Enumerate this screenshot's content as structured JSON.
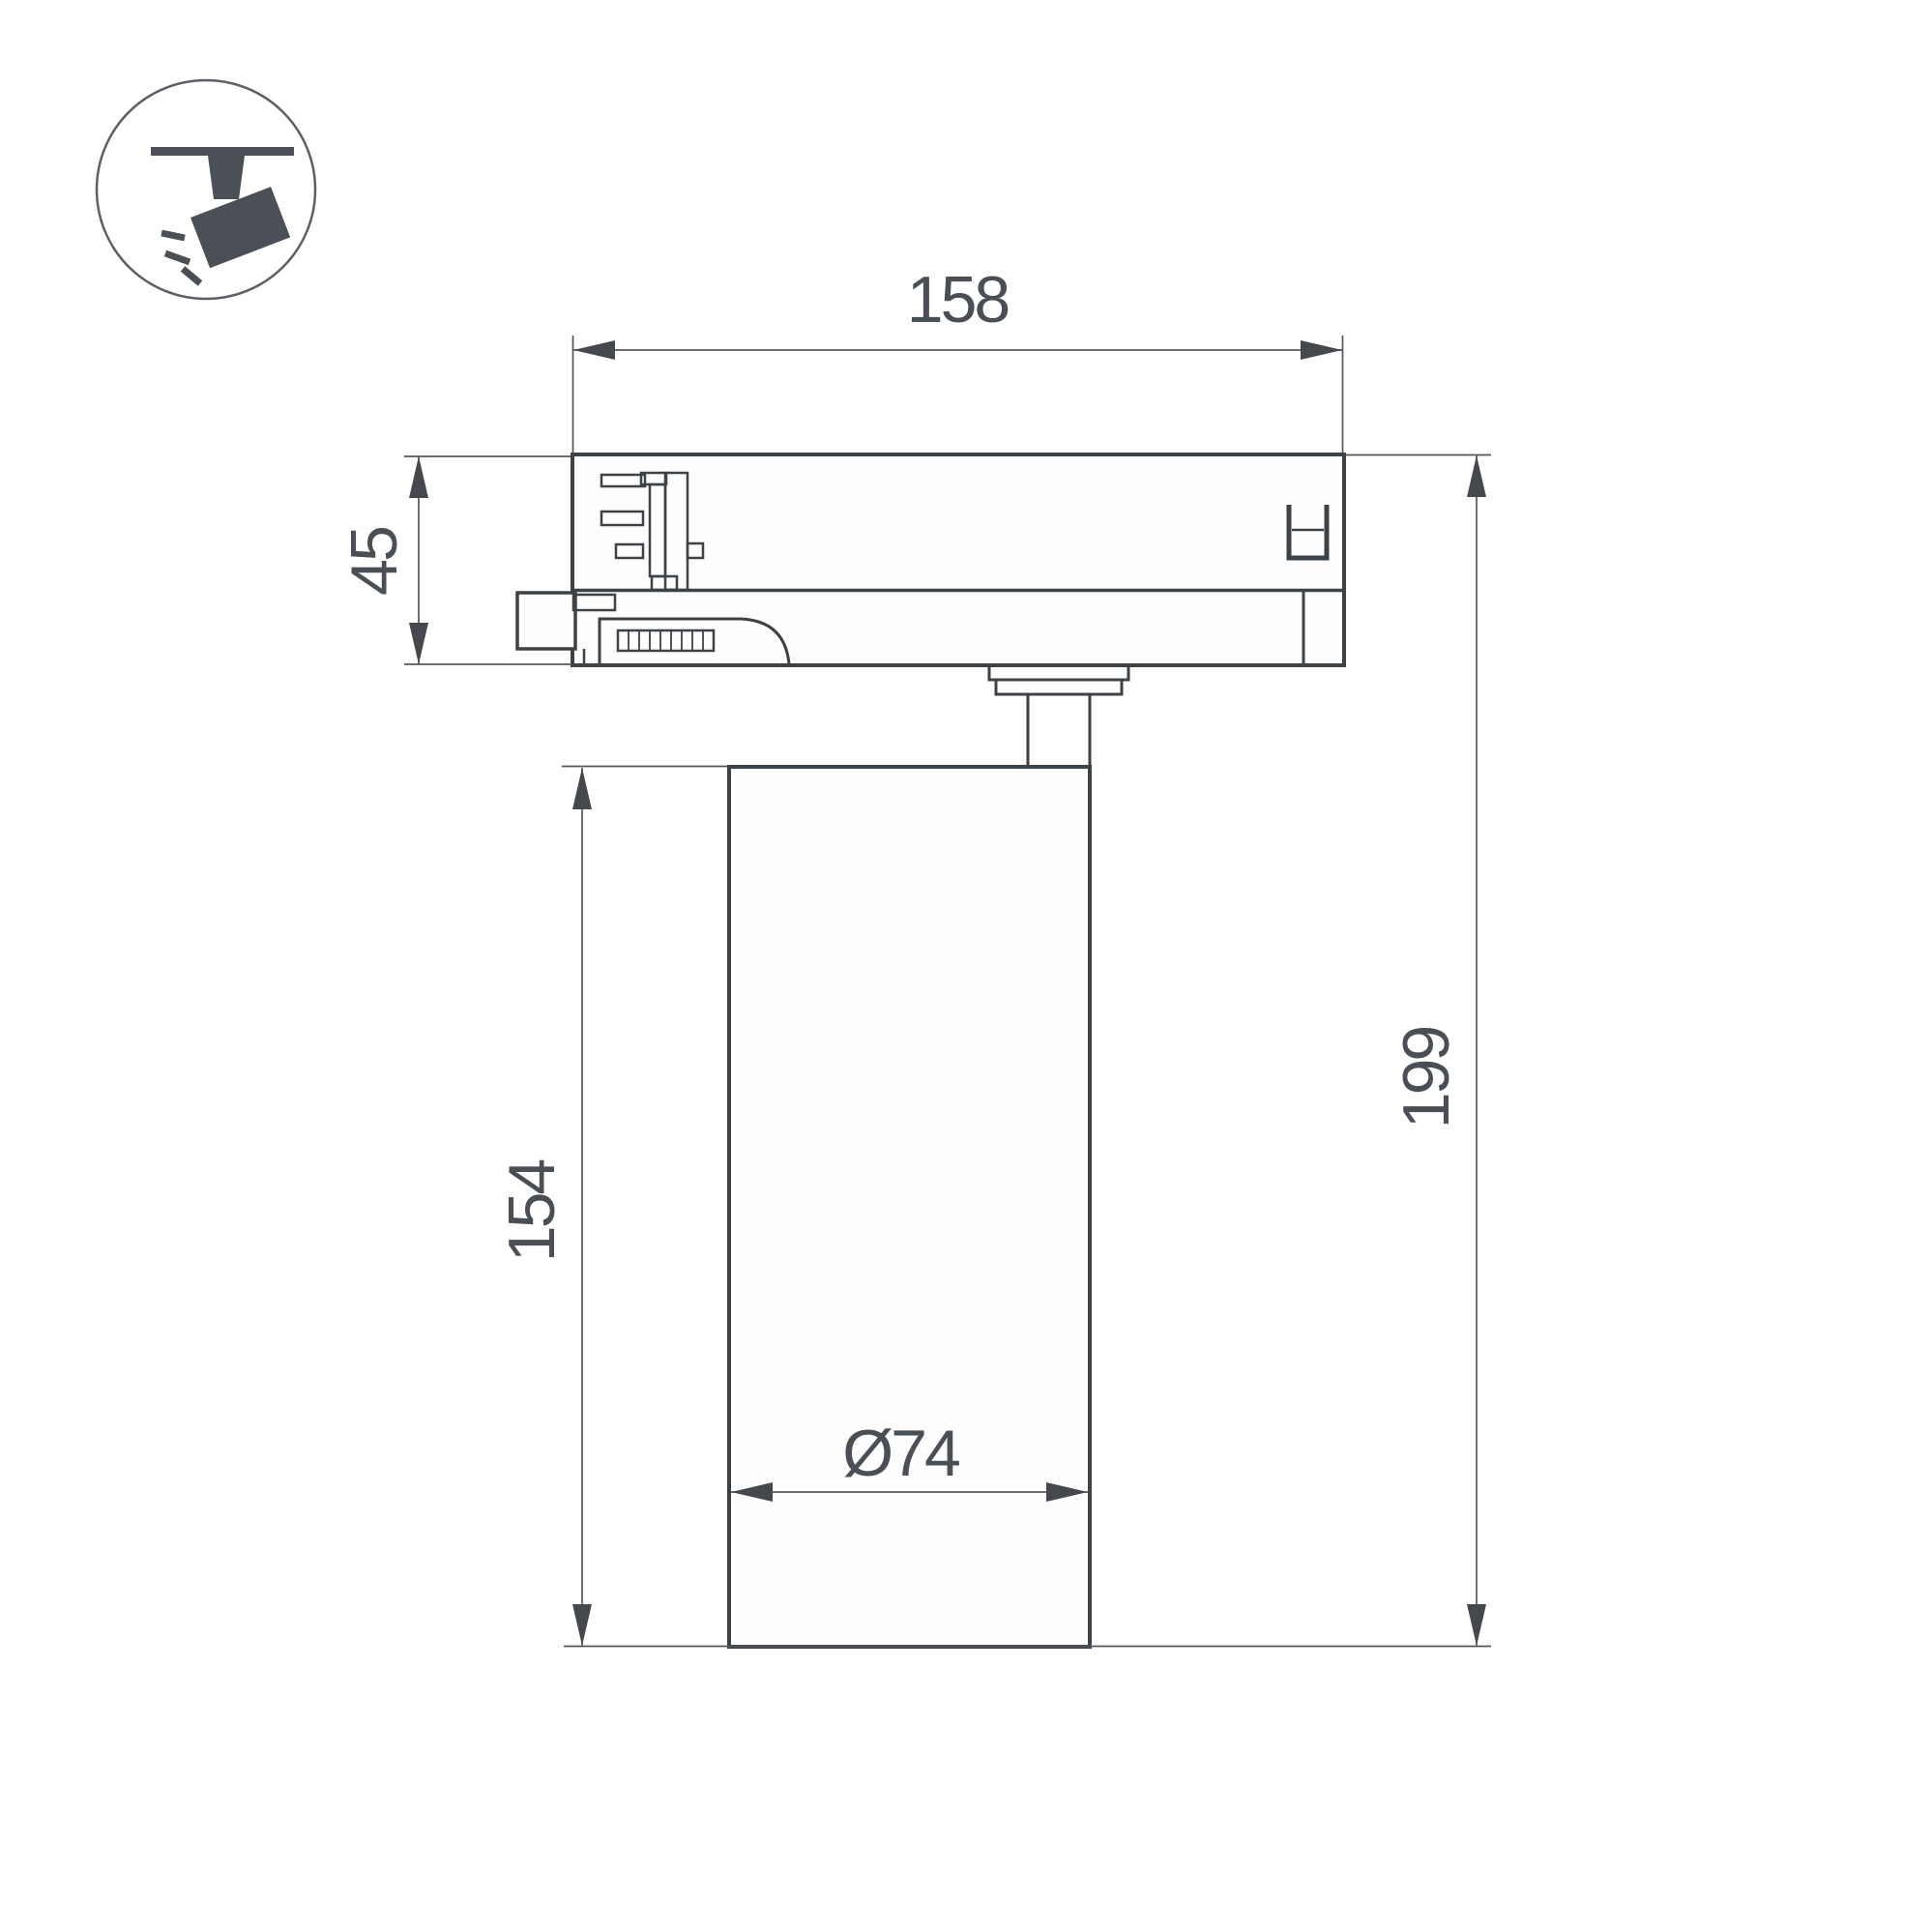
{
  "page": {
    "background": "#ffffff"
  },
  "icon": {
    "name": "track-spotlight-icon",
    "color": "#4a5056",
    "circle_stroke": "#5a6065"
  },
  "drawing": {
    "type": "technical-dimension-drawing",
    "subject": "track-mounted cylindrical spotlight, side view",
    "stroke_color": "#3d4247",
    "dim_color": "#54585d",
    "text_color": "#4a4f55",
    "labels": {
      "track_width": "158",
      "adapter_height": "45",
      "body_height": "154",
      "total_height": "199",
      "diameter": "Ø74"
    }
  }
}
